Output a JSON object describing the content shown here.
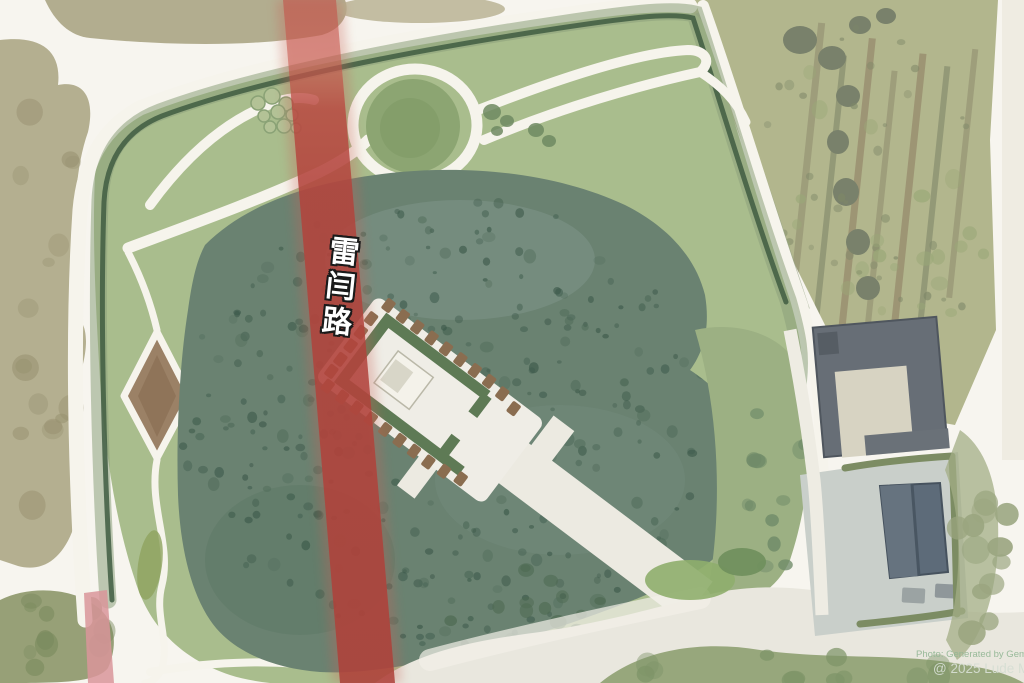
{
  "map": {
    "road_label": "雷闫路",
    "watermark": {
      "line1": "Photo: Generated by Gemi",
      "line2": "@ 2025 Lude Med"
    },
    "style": "watercolor aerial park map",
    "features": [
      "park-lawn",
      "woodland-mass",
      "circular-mound-with-ring-path",
      "diamond-garden-bed",
      "monument-complex-with-hedge-frame",
      "approach-road",
      "highlighted-road-overlay",
      "farmland-plots",
      "courtyard-building",
      "gabled-building",
      "paved-yard",
      "perimeter-hedge",
      "winding-paths"
    ],
    "colors": {
      "road_red": "#b2433c",
      "road_red_light": "#d9959a",
      "park_green": "#a9bd8d",
      "woods_green": "#66806d",
      "hedge_green": "#3f5c42",
      "path_white": "#f6f4ec",
      "farmland": "#b2b68d",
      "olive_band": "#aba583",
      "building_grey": "#676e76",
      "building_blue": "#5d6b79",
      "pavement_grey": "#c9cfca",
      "diamond_brown": "#9b8166",
      "monument_frame_green": "#5e7a55",
      "tree_dot_brown": "#8a6d50",
      "label_text": "#ffffff"
    }
  }
}
